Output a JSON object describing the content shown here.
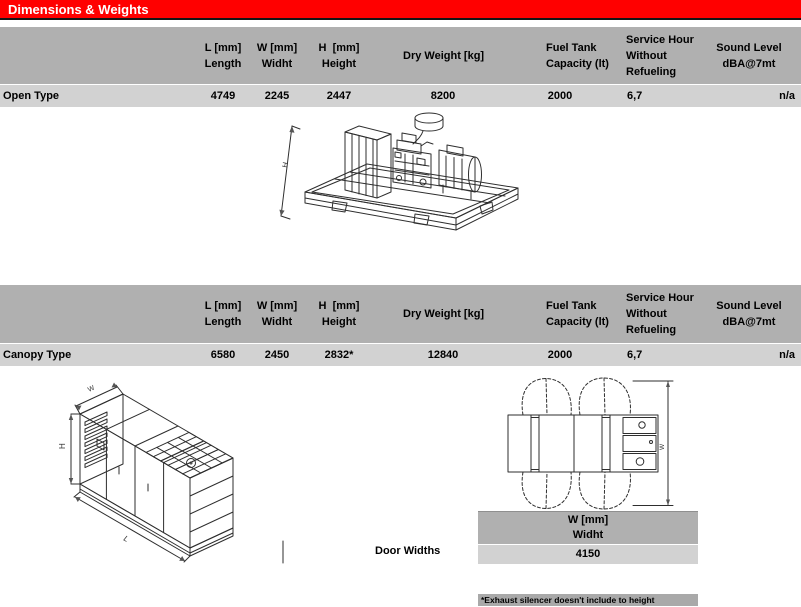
{
  "title": "Dimensions & Weights",
  "columns": {
    "l": "L [mm]\nLength",
    "w": "W [mm]\nWidht",
    "h": "H  [mm]\nHeight",
    "dry": "Dry Weight [kg]",
    "fuel": "Fuel Tank\nCapacity (lt)",
    "service": "Service Hour\nWithout\nRefueling",
    "sound": "Sound Level\ndBA@7mt"
  },
  "rows": {
    "open": {
      "label": "Open Type",
      "l": "4749",
      "w": "2245",
      "h": "2447",
      "dry": "8200",
      "fuel": "2000",
      "service": "6,7",
      "sound": "n/a"
    },
    "canopy": {
      "label": "Canopy Type",
      "l": "6580",
      "w": "2450",
      "h": "2832*",
      "dry": "12840",
      "fuel": "2000",
      "service": "6,7",
      "sound": "n/a"
    }
  },
  "door_widths": {
    "label": "Door Widths",
    "header": "W [mm]\nWidht",
    "value": "4150"
  },
  "footnote": "*Exhaust silencer doesn't include to height",
  "drawing_labels": {
    "open_h": "H",
    "canopy_h": "H",
    "canopy_w": "W",
    "canopy_l": "L",
    "door_w": "W"
  },
  "colors": {
    "title_bg": "#FF0000",
    "title_text": "#FFFFFF",
    "table_header_bg": "#B0B0B0",
    "table_row_bg": "#D2D2D2",
    "footnote_bg": "#A9A9A9"
  }
}
